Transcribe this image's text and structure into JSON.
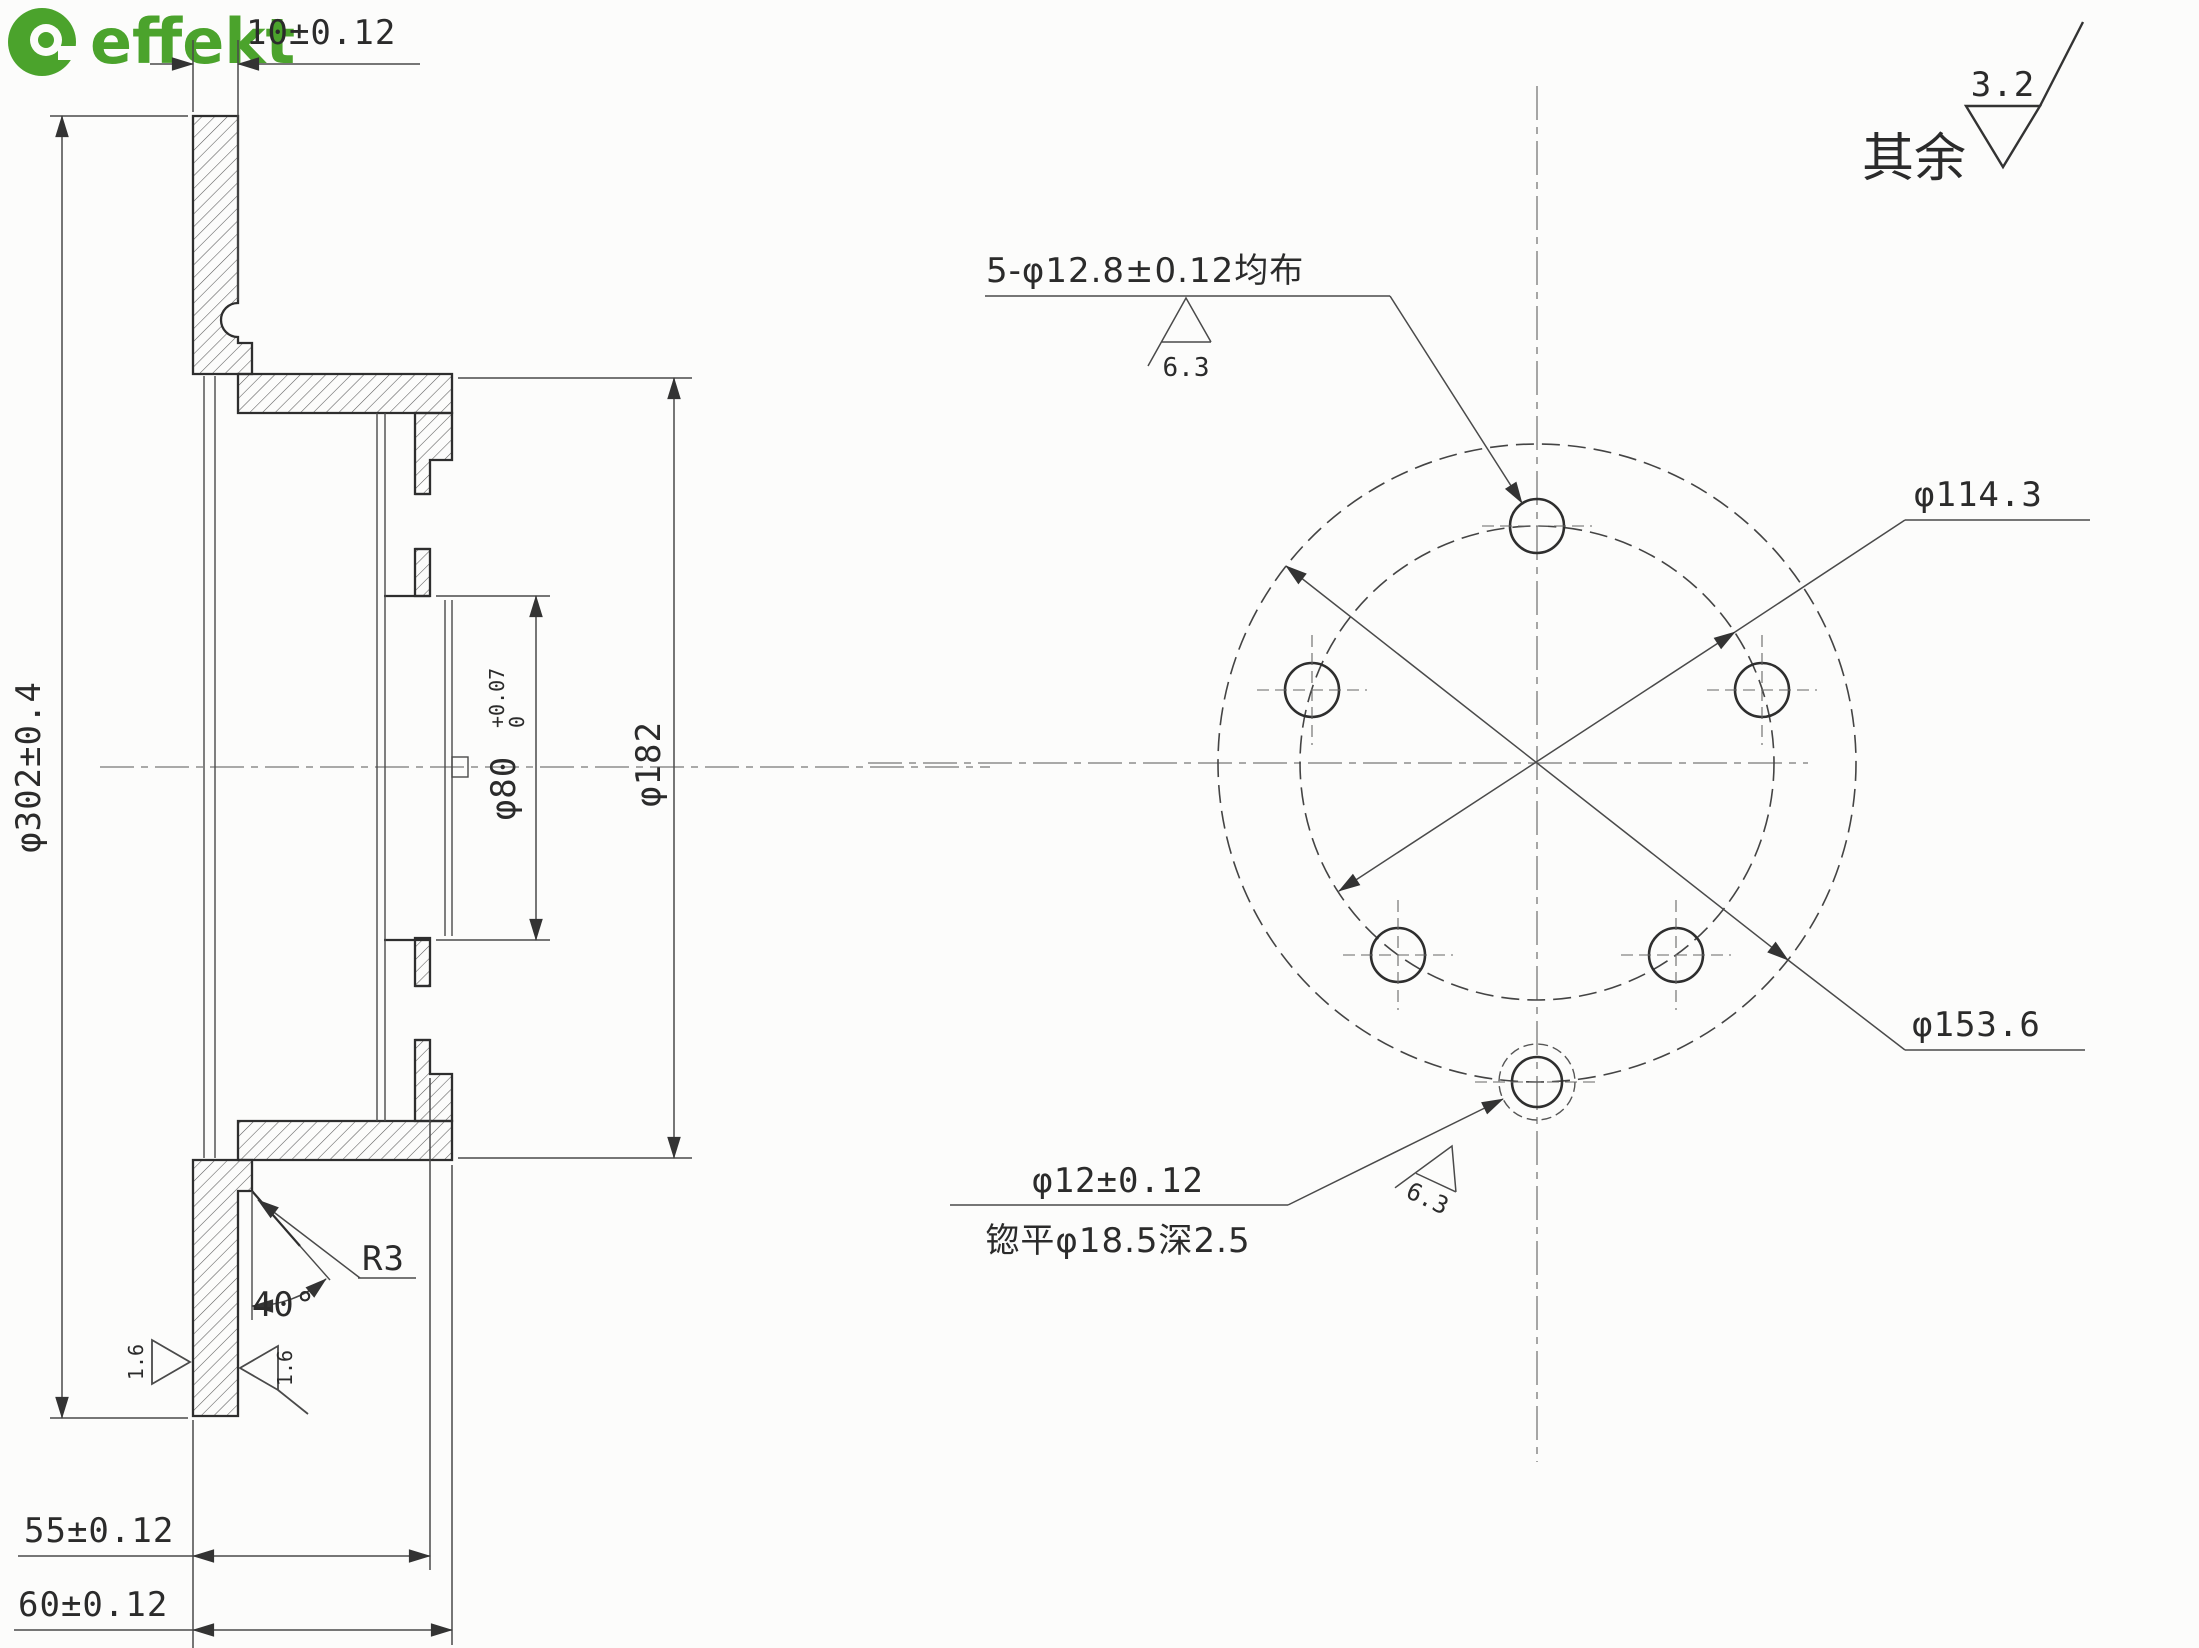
{
  "logo": {
    "brand": "effekt"
  },
  "general_note": {
    "prefix": "其余",
    "value": "3.2"
  },
  "section_view": {
    "thickness": "10±0.12",
    "outer_diameter": "φ302±0.4",
    "hat_diameter": "φ182",
    "bore_diameter": "φ80",
    "bore_tol_upper": "+0.07",
    "bore_tol_lower": "0",
    "inner_depth": "55±0.12",
    "overall_depth": "60±0.12",
    "chamfer_angle": "40°",
    "fillet_radius": "R3",
    "left_face_roughness": "1.6",
    "right_face_roughness": "1.6"
  },
  "front_view": {
    "bolt_holes_label": "5-φ12.8±0.12均布",
    "bolt_holes_roughness": "6.3",
    "bolt_circle_diameter": "φ114.3",
    "locating_circle_diameter": "φ153.6",
    "pin_hole_diameter": "φ12±0.12",
    "pin_hole_spotface": "锪平φ18.5深2.5",
    "pin_hole_roughness": "6.3"
  }
}
